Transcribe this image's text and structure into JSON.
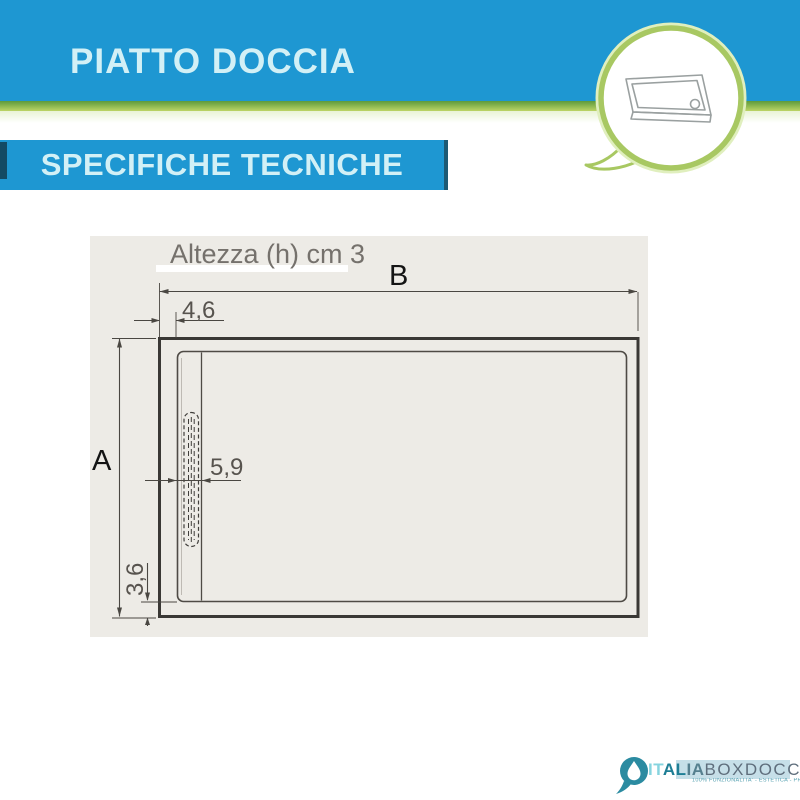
{
  "header": {
    "title": "PIATTO DOCCIA",
    "subtitle": "SPECIFICHE TECNICHE"
  },
  "diagram": {
    "height_note": "Altezza (h) cm 3",
    "dim_b": "B",
    "dim_a": "A",
    "dim_edge": "4,6",
    "dim_channel": "5,9",
    "dim_bottom": "3,6"
  },
  "logo": {
    "brand_it": "IT",
    "brand_al": "AL",
    "brand_ia": "IA",
    "brand_box": "BOXDOCCIA",
    "tagline": "100% FUNZIONALITA' - ESTETICA - PRATICITA'"
  },
  "colors": {
    "blue-bar": "#1e97d2",
    "bar-text": "#d2f0f6",
    "green-stripe": "#7fae43",
    "bubble-ring": "#a8c862",
    "panel-bg": "#edebe6",
    "line": "#3e3b37",
    "dim-text": "#57534e",
    "logo-teal": "#2b8ba1"
  }
}
